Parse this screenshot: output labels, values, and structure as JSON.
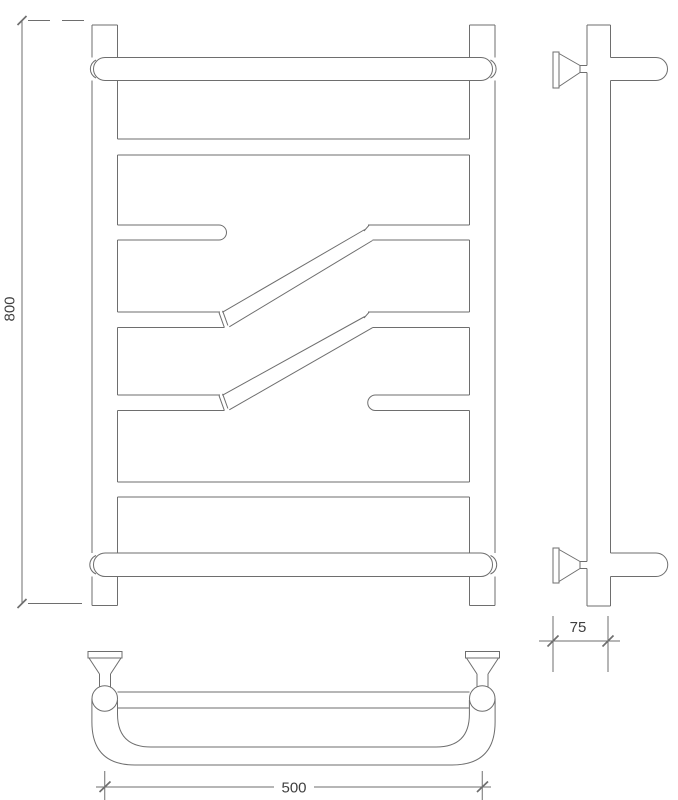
{
  "drawing": {
    "background": "#ffffff",
    "line_color": "#6e6e6e",
    "text_color": "#3f3f3f"
  },
  "dimensions": {
    "height": {
      "value": "800"
    },
    "width": {
      "value": "500"
    },
    "depth": {
      "value": "75"
    }
  }
}
